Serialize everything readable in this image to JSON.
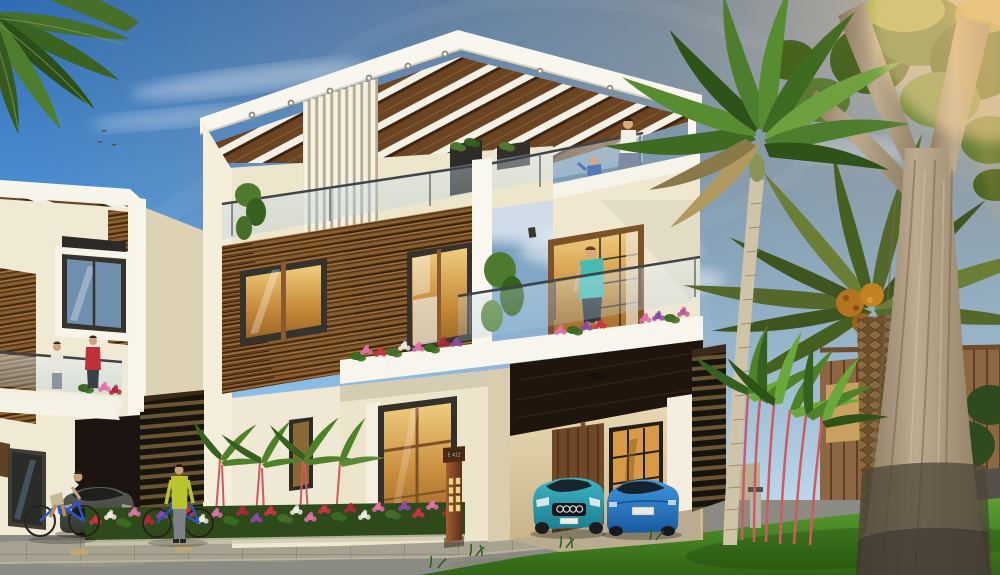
{
  "scene": {
    "type": "3d-architectural-rendering",
    "setting": "modern triplex villa exterior, sunny day",
    "signpost": {
      "label": "E 412"
    },
    "objects": [
      "sky",
      "clouds",
      "birds",
      "foreground-palm-frond",
      "left-villa",
      "main-villa",
      "roof-pergola",
      "vertical-fins",
      "glass-balcony",
      "wood-clad-facade",
      "amber-windows",
      "carport",
      "teal-car",
      "blue-car",
      "gray-car",
      "unit-signpost",
      "flower-bed",
      "red-stem-palms",
      "royal-palm",
      "date-palm",
      "large-tree",
      "wooden-fence",
      "lawn",
      "road",
      "paved-walkway",
      "cyclist",
      "man-with-bicycle",
      "woman-on-terrace",
      "child-on-terrace",
      "man-at-window",
      "people-on-left-balcony"
    ]
  },
  "palette": {
    "sky_blue": "#2e6cb4",
    "sky_horizon": "#d7ecf8",
    "sun_glow": "#ffc978",
    "wall_white": "#f8f6ec",
    "wall_cream": "#efe8d2",
    "wood_brown": "#7c5328",
    "frame_dark": "#35332c",
    "window_amber": "#d89b45",
    "glass_blue": "#bcd8e6",
    "road_gray": "#8b8a83",
    "paver_tan": "#c8a871",
    "grass_green": "#3f8420",
    "palm_green": "#4f7d2e",
    "lipstick_red": "#cf5a60",
    "fence_brown": "#8d6742",
    "bark_light": "#b3a286",
    "car_teal": "#2aa7b8",
    "car_blue": "#2f8ad8",
    "car_gray": "#4e5348",
    "shirt_yellow": "#bac431",
    "shirt_teal": "#46bdb2",
    "flower_pink": "#e070a8",
    "flower_red": "#cc3344",
    "flower_purple": "#8a4aa8"
  }
}
